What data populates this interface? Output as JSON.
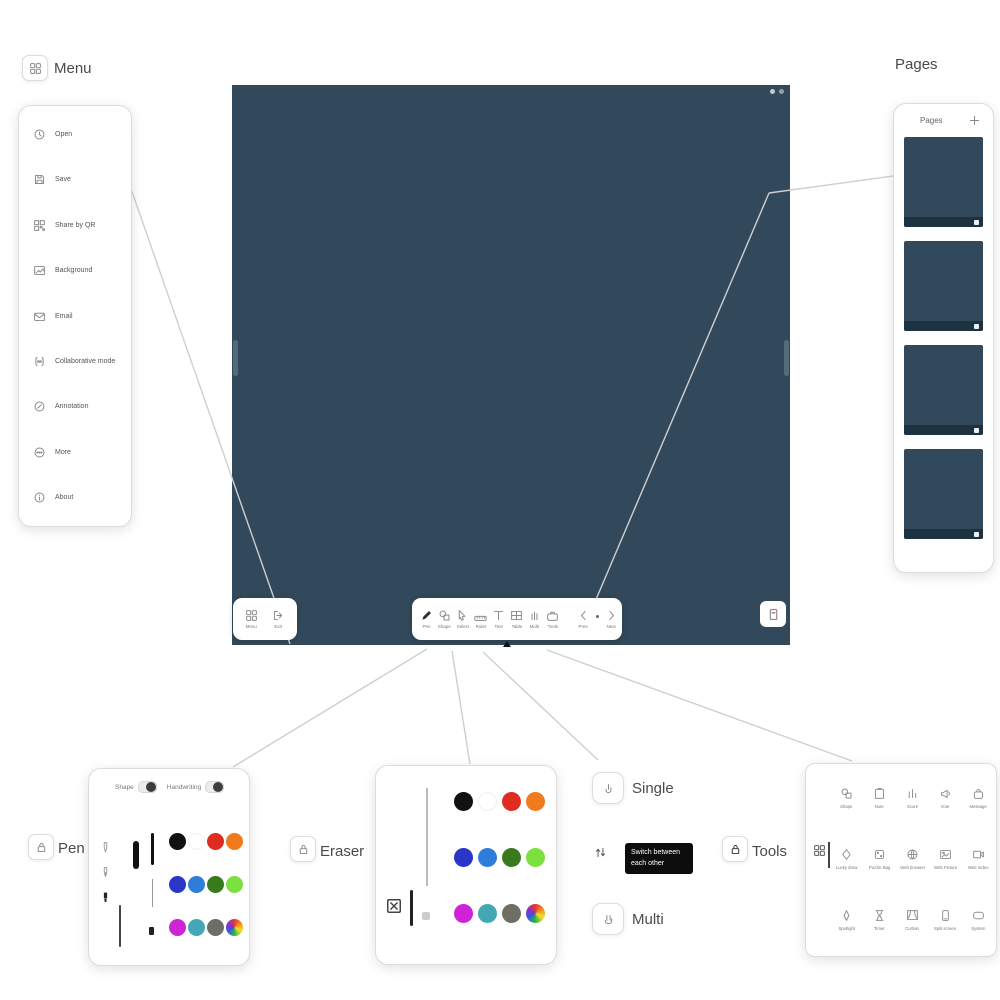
{
  "app": {
    "canvas_color": "#31495a",
    "thumb_strip_color": "#1d3240"
  },
  "callouts": {
    "menu_label": "Menu",
    "pages_label": "Pages",
    "pen_label": "Pen",
    "eraser_label": "Eraser",
    "single_label": "Single",
    "multi_label": "Multi",
    "tools_label": "Tools",
    "tooltip": "Switch between each other"
  },
  "menu": {
    "items": [
      {
        "icon": "clock",
        "label": "Open"
      },
      {
        "icon": "save",
        "label": "Save"
      },
      {
        "icon": "qr",
        "label": "Share by QR"
      },
      {
        "icon": "image",
        "label": "Background"
      },
      {
        "icon": "mail",
        "label": "Email"
      },
      {
        "icon": "collab",
        "label": "Collaborative mode"
      },
      {
        "icon": "annot",
        "label": "Annotation"
      },
      {
        "icon": "more",
        "label": "More"
      },
      {
        "icon": "about",
        "label": "About"
      }
    ]
  },
  "toolbar": {
    "left": [
      {
        "icon": "grid4",
        "label": "Menu"
      },
      {
        "icon": "exit",
        "label": "Exit"
      }
    ],
    "center": [
      {
        "icon": "pen",
        "label": "Pen",
        "active": true
      },
      {
        "icon": "shape",
        "label": "Shape"
      },
      {
        "icon": "select",
        "label": "Select"
      },
      {
        "icon": "ruler",
        "label": "Ruler"
      },
      {
        "icon": "text",
        "label": "Text"
      },
      {
        "icon": "table",
        "label": "Table"
      },
      {
        "icon": "multi",
        "label": "Multi"
      },
      {
        "icon": "tools",
        "label": "Tools"
      }
    ],
    "nav": {
      "prev_label": "Prev",
      "next_label": "Next"
    }
  },
  "pen_popup": {
    "toggles": [
      {
        "label": "Shape",
        "on": true
      },
      {
        "label": "Handwriting",
        "on": true
      }
    ],
    "pen_types": [
      "ballpoint-pen",
      "fountain-pen",
      "marker-pen"
    ],
    "selected_pen_type": "marker-pen"
  },
  "palette": {
    "colors": [
      {
        "name": "black",
        "hex": "#111111"
      },
      {
        "name": "white",
        "hex": "#ffffff"
      },
      {
        "name": "red",
        "hex": "#e02b20"
      },
      {
        "name": "orange",
        "hex": "#f07b1d"
      },
      {
        "name": "navy",
        "hex": "#2936c8"
      },
      {
        "name": "blue",
        "hex": "#2e7ddb"
      },
      {
        "name": "dark-green",
        "hex": "#3a7a1e"
      },
      {
        "name": "light-green",
        "hex": "#7ce03f"
      },
      {
        "name": "magenta",
        "hex": "#d023d8"
      },
      {
        "name": "teal",
        "hex": "#44a8b4"
      },
      {
        "name": "gray",
        "hex": "#6e6e64"
      },
      {
        "name": "custom",
        "hex": "rainbow"
      }
    ]
  },
  "pages_panel": {
    "title": "Pages",
    "page_count": 4
  },
  "tools_panel": {
    "items": [
      {
        "icon": "shape",
        "label": "Shape"
      },
      {
        "icon": "note",
        "label": "Note"
      },
      {
        "icon": "score",
        "label": "Score"
      },
      {
        "icon": "vote",
        "label": "Vote"
      },
      {
        "icon": "bag",
        "label": "Message"
      },
      {
        "icon": "diamond",
        "label": "Lucky draw"
      },
      {
        "icon": "dice",
        "label": "Puzzle Bag"
      },
      {
        "icon": "globe",
        "label": "Web browser"
      },
      {
        "icon": "picture",
        "label": "Web Picture"
      },
      {
        "icon": "video",
        "label": "Web Video"
      },
      {
        "icon": "spotlight",
        "label": "Spotlight"
      },
      {
        "icon": "hourglass",
        "label": "Timer"
      },
      {
        "icon": "curtain",
        "label": "Curtain"
      },
      {
        "icon": "phone",
        "label": "Split screen"
      },
      {
        "icon": "sysrect",
        "label": "System"
      }
    ]
  }
}
